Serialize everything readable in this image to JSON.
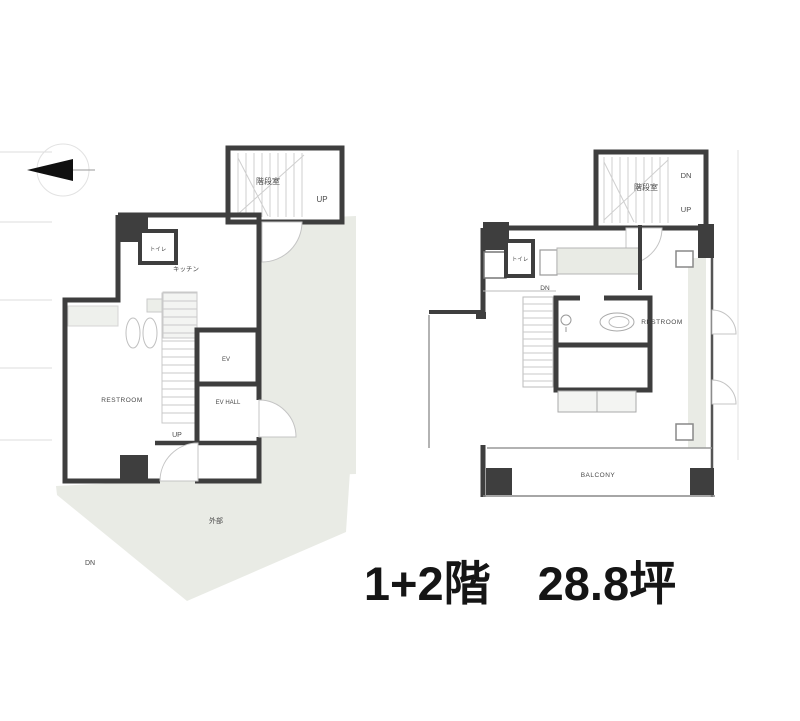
{
  "caption": "1+2階　28.8坪",
  "icons": {
    "compass": "north-arrow"
  },
  "floor1": {
    "stairwell_label": "階段室",
    "stairwell_up": "UP",
    "toilet_label": "トイレ",
    "kitchen_label": "キッチン",
    "elevator_label": "EV",
    "ev_hall_label": "EV HALL",
    "stairs_up": "UP",
    "room_label": "RESTROOM",
    "exterior_label": "外部",
    "exterior_dn": "DN"
  },
  "floor2": {
    "stairwell_label": "階段室",
    "stairwell_dn": "DN",
    "stairwell_up": "UP",
    "toilet_label": "トイレ",
    "step_dn": "DN",
    "room_label": "RESTROOM",
    "balcony_label": "BALCONY"
  },
  "colors": {
    "wall": "#3e3e3e",
    "shade": "#e9ebe5",
    "caption_text": "#151515"
  }
}
